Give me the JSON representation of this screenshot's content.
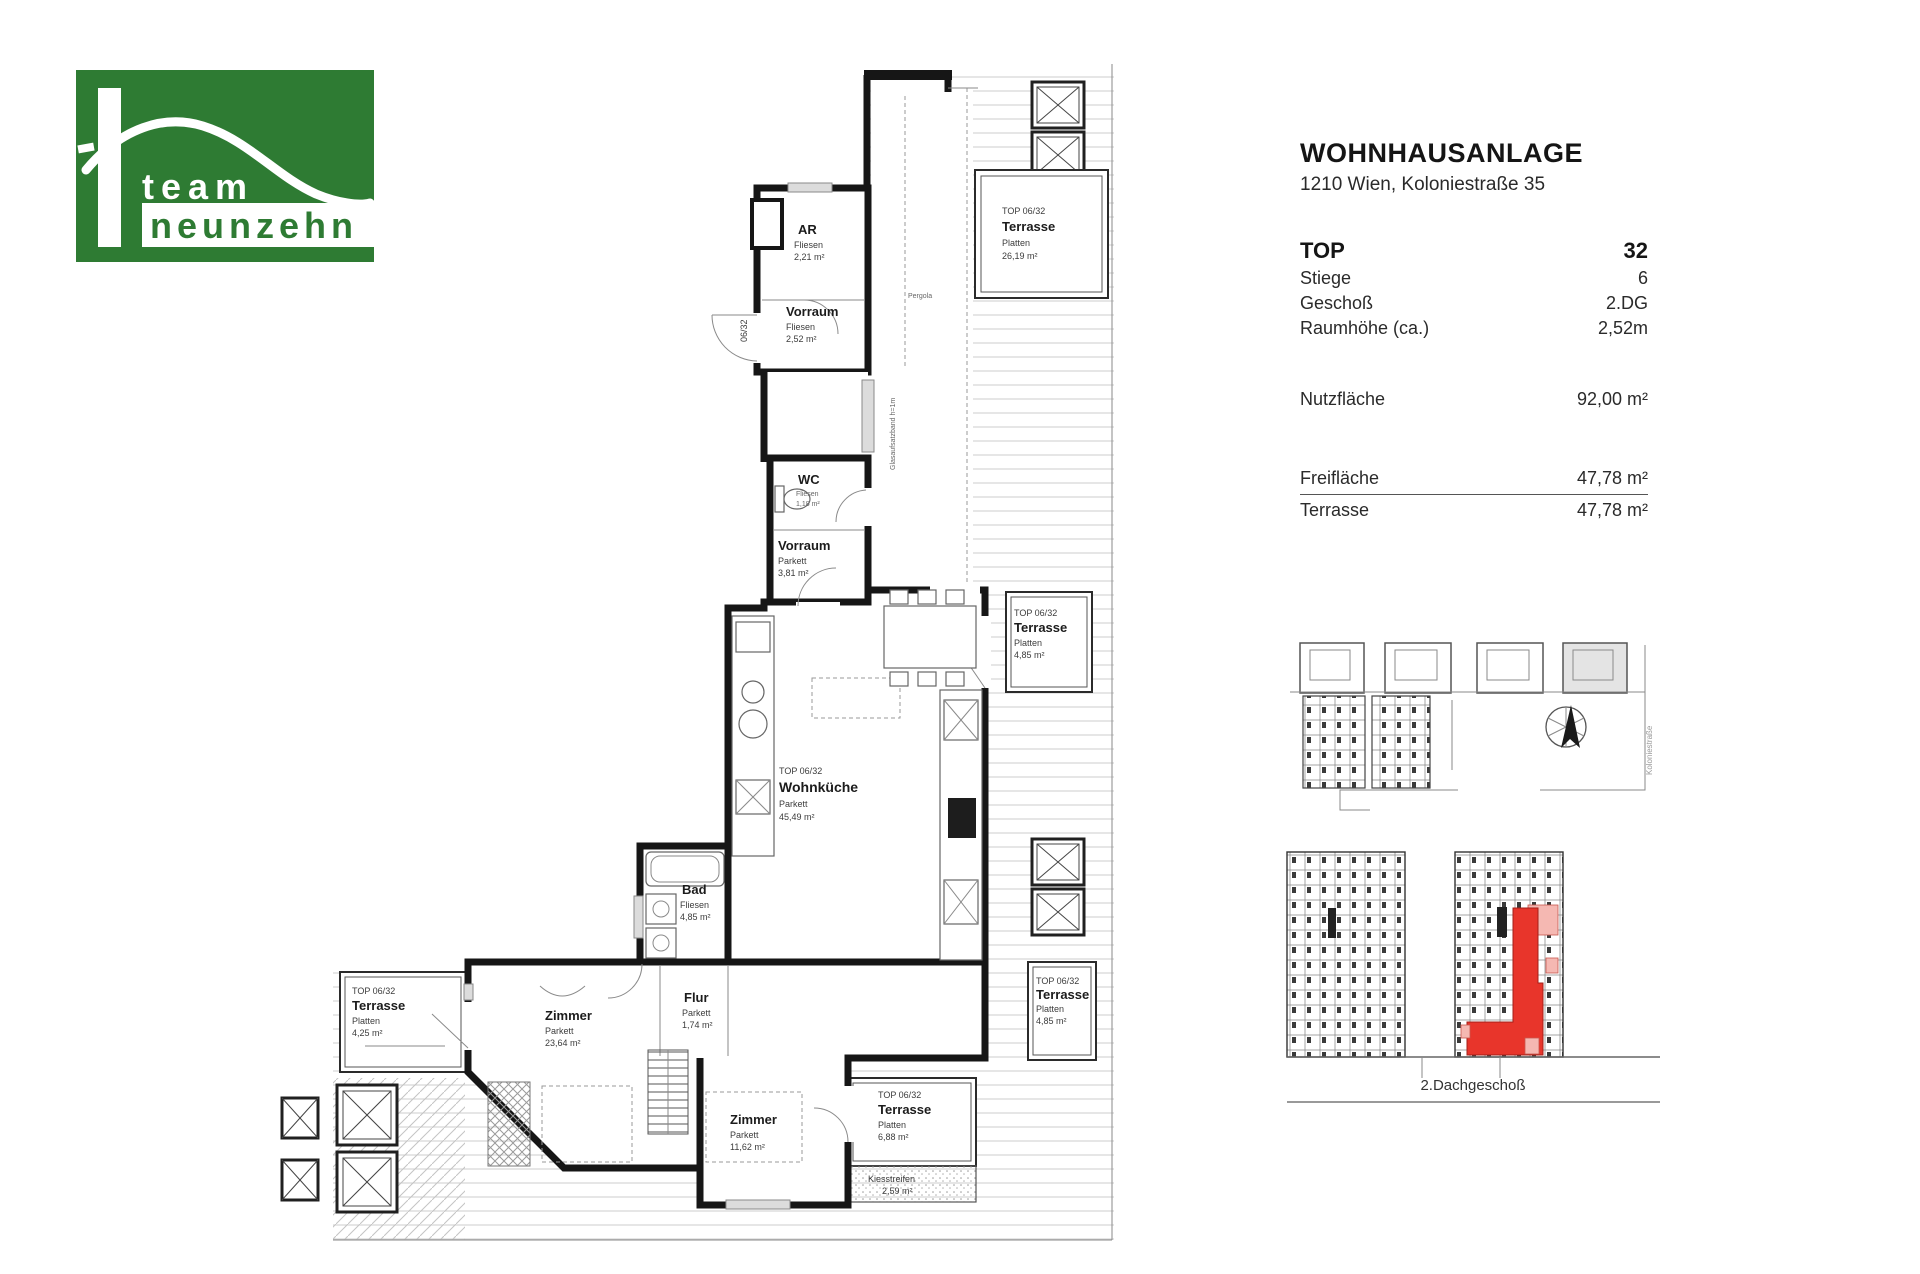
{
  "logo": {
    "team": "team",
    "neunzehn": "neunzehn",
    "green": "#2e7b33"
  },
  "info": {
    "title": "WOHNHAUSANLAGE",
    "address": "1210 Wien, Koloniestraße 35",
    "rows": [
      {
        "label": "TOP",
        "value": "32"
      },
      {
        "label": "Stiege",
        "value": "6"
      },
      {
        "label": "Geschoß",
        "value": "2.DG"
      },
      {
        "label": "Raumhöhe (ca.)",
        "value": "2,52m"
      }
    ],
    "nutz": {
      "label": "Nutzfläche",
      "value": "92,00 m²"
    },
    "frei": {
      "label": "Freifläche",
      "value": "47,78 m²"
    },
    "terrasse": {
      "label": "Terrasse",
      "value": "47,78 m²"
    }
  },
  "plan": {
    "rooms": {
      "ar": {
        "name": "AR",
        "material": "Fliesen",
        "area": "2,21 m²"
      },
      "vorraum1": {
        "name": "Vorraum",
        "material": "Fliesen",
        "area": "2,52 m²"
      },
      "wc": {
        "name": "WC",
        "material": "Fliesen",
        "area": "1,18 m²"
      },
      "vorraum2": {
        "name": "Vorraum",
        "material": "Parkett",
        "area": "3,81 m²"
      },
      "wohnkueche": {
        "tag": "TOP 06/32",
        "name": "Wohnküche",
        "material": "Parkett",
        "area": "45,49 m²"
      },
      "bad": {
        "name": "Bad",
        "material": "Fliesen",
        "area": "4,85 m²"
      },
      "flur": {
        "name": "Flur",
        "material": "Parkett",
        "area": "1,74 m²"
      },
      "zimmer1": {
        "name": "Zimmer",
        "material": "Parkett",
        "area": "23,64 m²"
      },
      "zimmer2": {
        "name": "Zimmer",
        "material": "Parkett",
        "area": "11,62 m²"
      }
    },
    "terraces": {
      "top": {
        "tag": "TOP 06/32",
        "name": "Terrasse",
        "material": "Platten",
        "area": "26,19 m²"
      },
      "mid_right": {
        "tag": "TOP 06/32",
        "name": "Terrasse",
        "material": "Platten",
        "area": "4,85 m²"
      },
      "low_right": {
        "tag": "TOP 06/32",
        "name": "Terrasse",
        "material": "Platten",
        "area": "4,85 m²"
      },
      "bottom": {
        "tag": "TOP 06/32",
        "name": "Terrasse",
        "material": "Platten",
        "area": "6,88 m²"
      },
      "left": {
        "tag": "TOP 06/32",
        "name": "Terrasse",
        "material": "Platten",
        "area": "4,25 m²"
      }
    },
    "notes": {
      "pergola": "Pergola",
      "kies_label": "Kiesstreifen",
      "kies_area": "2,59 m²",
      "door_label": "06/32",
      "glass_note": "Glasaufsatzband h=1m"
    }
  },
  "site": {
    "floor_label": "2.Dachgeschoß",
    "street_label": "Koloniestraße",
    "highlight_red": "#e8352b",
    "highlight_pink": "#f5b8b2"
  }
}
